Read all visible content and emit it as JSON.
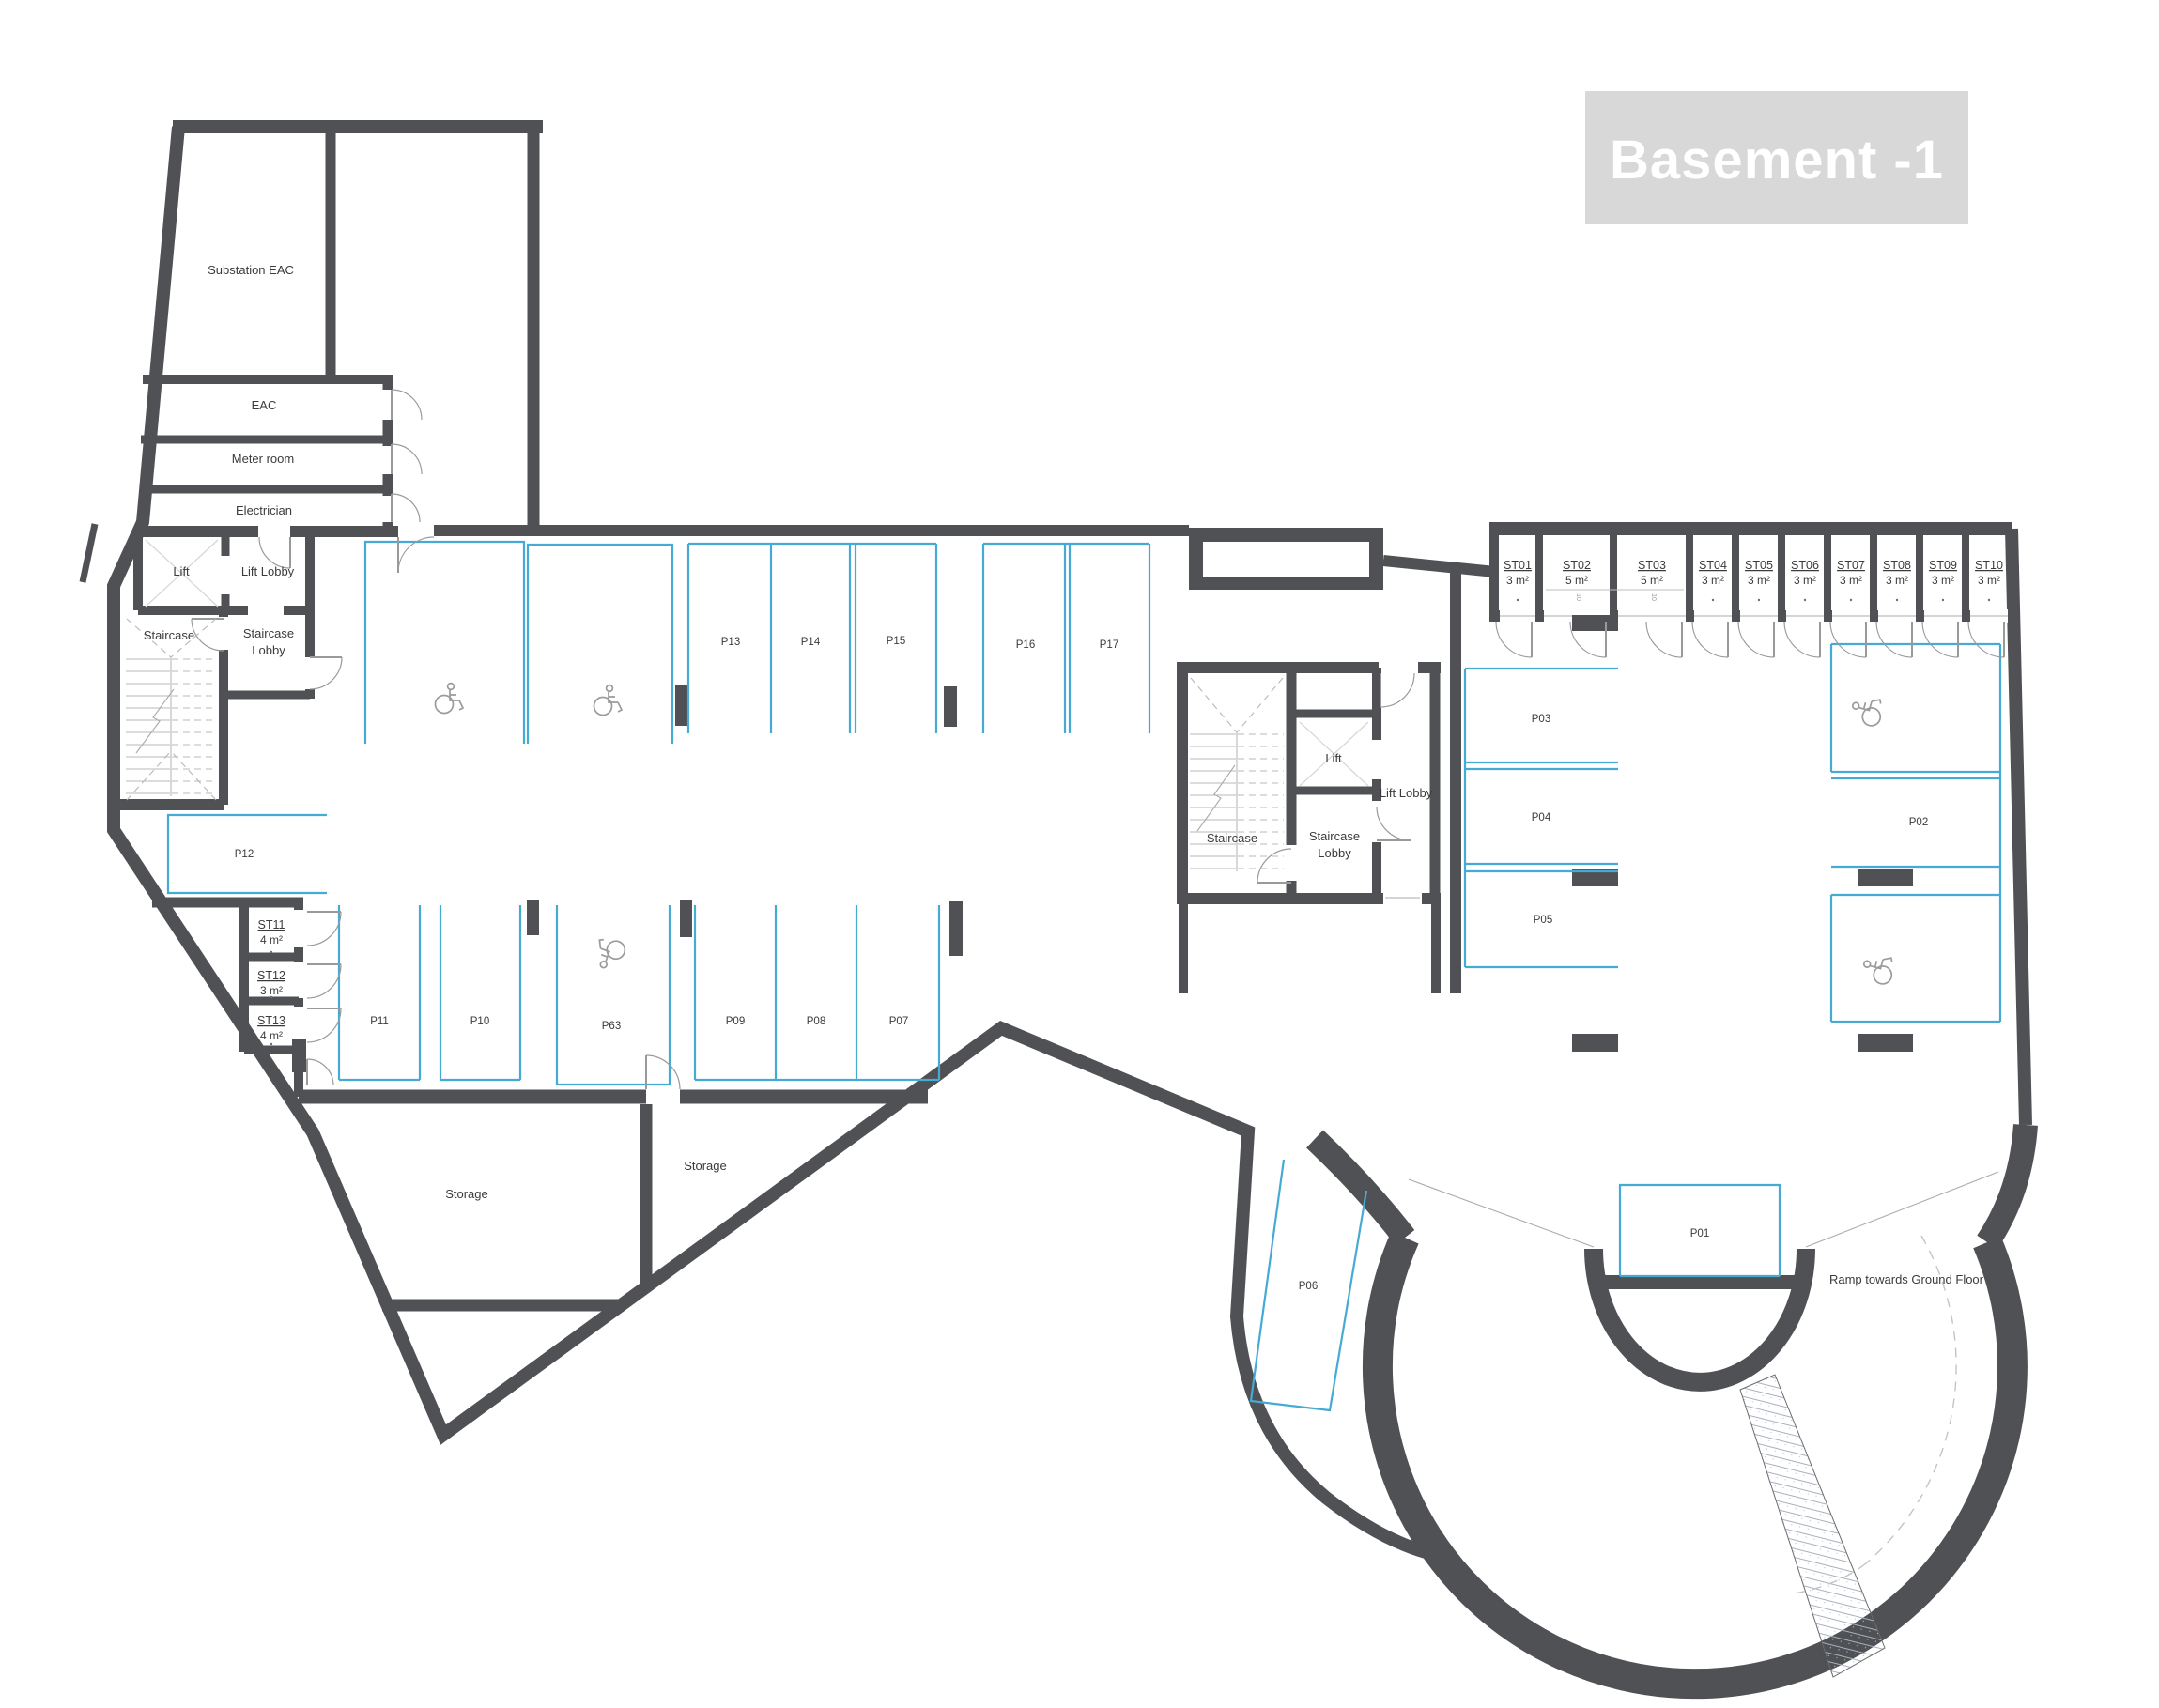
{
  "title": "Basement -1",
  "rooms": {
    "substation": "Substation EAC",
    "eac": "EAC",
    "meter_room": "Meter room",
    "electrician": "Electrician",
    "lift": "Lift",
    "lift_lobby": "Lift Lobby",
    "staircase": "Staircase",
    "staircase_lobby_line1": "Staircase",
    "staircase_lobby_line2": "Lobby",
    "storage": "Storage",
    "ramp_note": "Ramp towards Ground Floor"
  },
  "parking": {
    "p01": "P01",
    "p02": "P02",
    "p03": "P03",
    "p04": "P04",
    "p05": "P05",
    "p06": "P06",
    "p07": "P07",
    "p08": "P08",
    "p09": "P09",
    "p10": "P10",
    "p11": "P11",
    "p12": "P12",
    "p13": "P13",
    "p14": "P14",
    "p15": "P15",
    "p16": "P16",
    "p17": "P17",
    "p63": "P63"
  },
  "storage_units": [
    {
      "id": "ST01",
      "area": "3 m²"
    },
    {
      "id": "ST02",
      "area": "5 m²"
    },
    {
      "id": "ST03",
      "area": "5 m²"
    },
    {
      "id": "ST04",
      "area": "3 m²"
    },
    {
      "id": "ST05",
      "area": "3 m²"
    },
    {
      "id": "ST06",
      "area": "3 m²"
    },
    {
      "id": "ST07",
      "area": "3 m²"
    },
    {
      "id": "ST08",
      "area": "3 m²"
    },
    {
      "id": "ST09",
      "area": "3 m²"
    },
    {
      "id": "ST10",
      "area": "3 m²"
    },
    {
      "id": "ST11",
      "area": "4 m²"
    },
    {
      "id": "ST12",
      "area": "3 m²"
    },
    {
      "id": "ST13",
      "area": "4 m²"
    }
  ],
  "unit_mark": "10",
  "colors": {
    "wall": "#4f5154",
    "parking_line": "#45abd4",
    "title_bg": "#d8d8d8",
    "title_text": "#ffffff",
    "text": "#3b3b3b",
    "door": "#9a9a9a",
    "stair": "#b8b8b8"
  }
}
